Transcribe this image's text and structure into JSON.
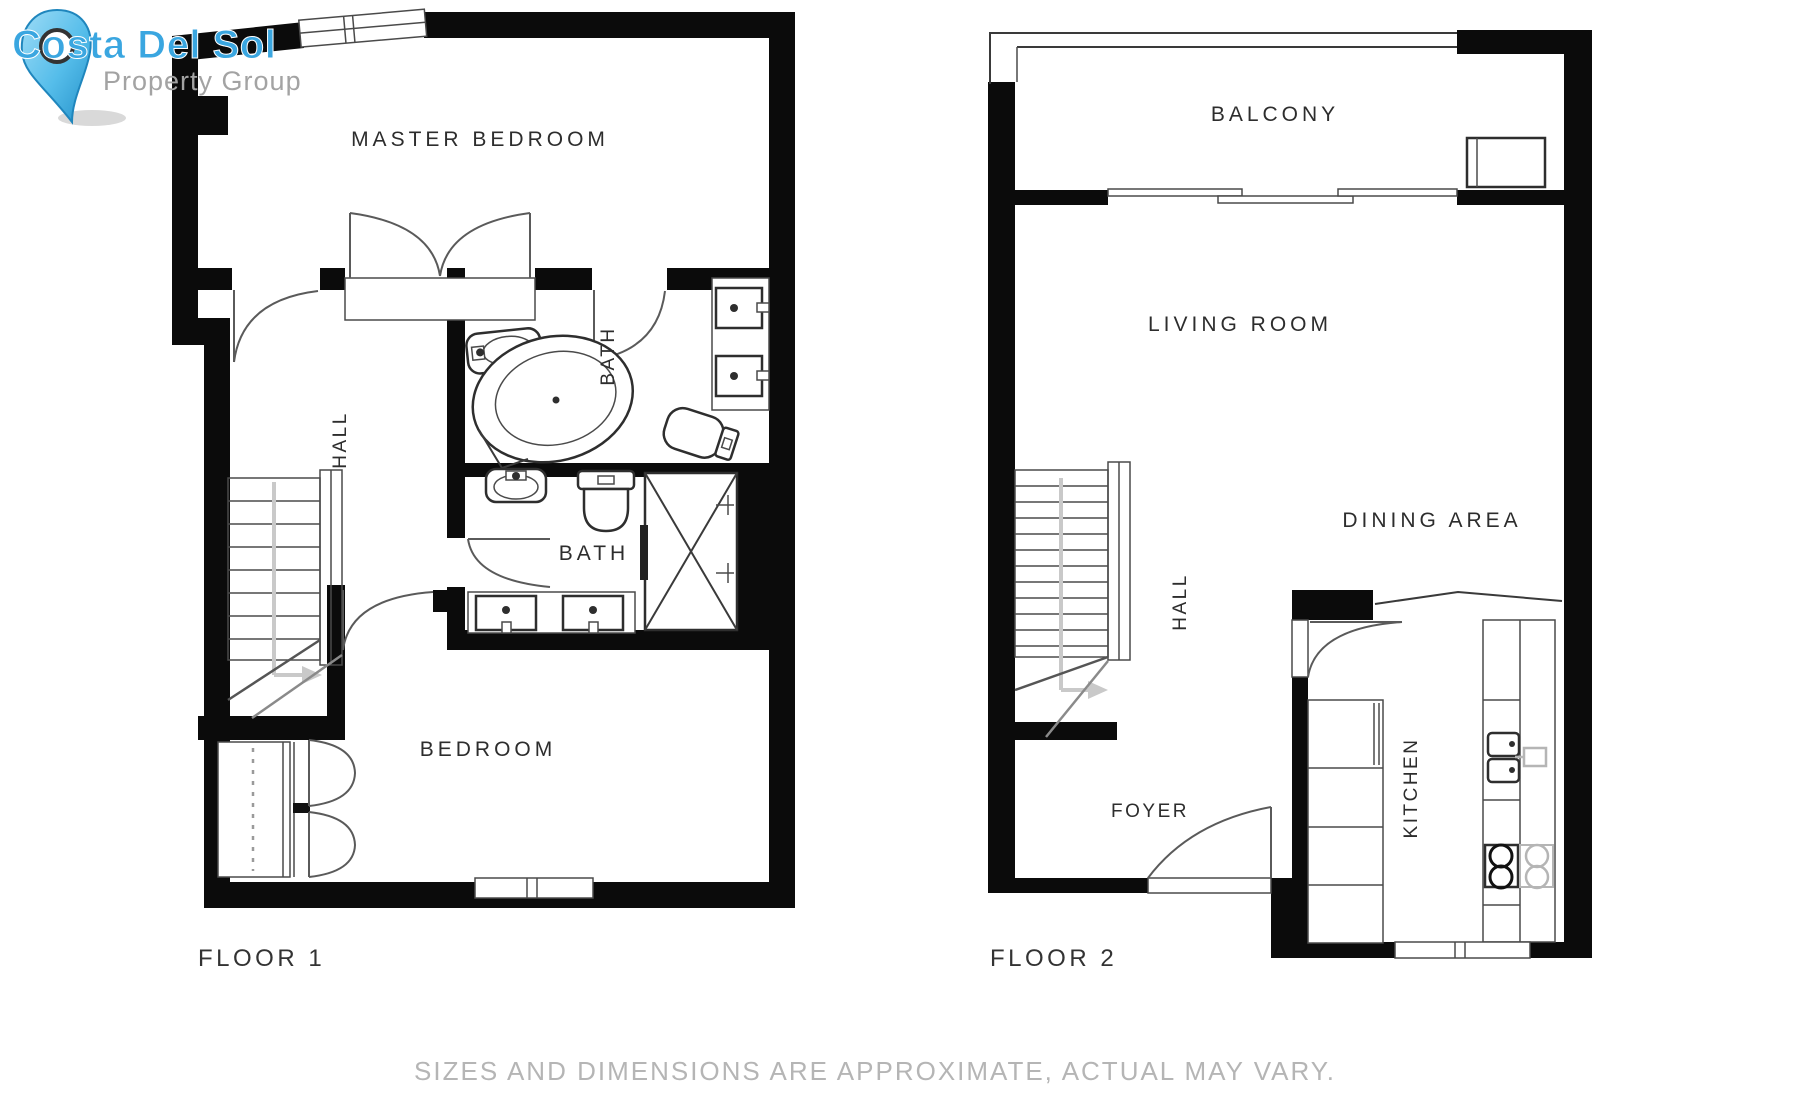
{
  "logo": {
    "title": "Costa Del Sol",
    "subtitle": "Property Group",
    "accent_color": "#3aa6e0",
    "subtitle_color": "#a3a3a3",
    "pin_color": "#55bdea"
  },
  "floor1": {
    "name": "FLOOR 1",
    "rooms": {
      "master_bedroom": "MASTER BEDROOM",
      "hall": "HALL",
      "bath_upper": "BATH",
      "bath_lower": "BATH",
      "bedroom": "BEDROOM"
    }
  },
  "floor2": {
    "name": "FLOOR 2",
    "rooms": {
      "balcony": "BALCONY",
      "living_room": "LIVING ROOM",
      "dining_area": "DINING AREA",
      "hall": "HALL",
      "foyer": "FOYER",
      "kitchen": "KITCHEN"
    }
  },
  "disclaimer": "SIZES AND DIMENSIONS ARE APPROXIMATE, ACTUAL MAY VARY.",
  "colors": {
    "walls": "#0b0b0b",
    "line_work": "#3a3a3a",
    "label_text": "#2d2d2d",
    "disclaimer_text": "#b5b5b5"
  }
}
